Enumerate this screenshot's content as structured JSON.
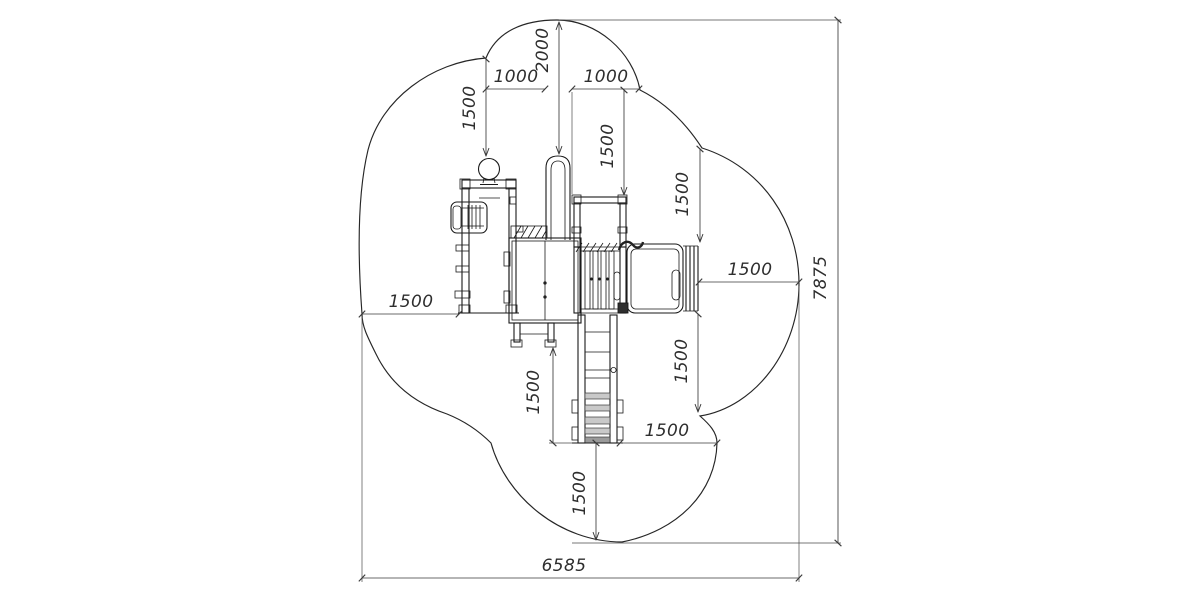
{
  "colors": {
    "background": "#ffffff",
    "equipment_line": "#1a1a1a",
    "dimension_line": "#3a3a3a",
    "text": "#2e2e2e",
    "step_fill": "#c9c9c9"
  },
  "dims": {
    "top_height": "2000",
    "top_left_width": "1000",
    "top_right_width": "1000",
    "upper_left_clearance": "1500",
    "upper_mid_clearance": "1500",
    "right_upper_clearance": "1500",
    "right_side_clearance": "1500",
    "right_lower_clearance": "1500",
    "left_side_clearance": "1500",
    "lower_left_clearance": "1500",
    "lower_right_clearance": "1500",
    "bottom_clearance": "1500",
    "overall_width": "6585",
    "overall_height": "7875"
  }
}
